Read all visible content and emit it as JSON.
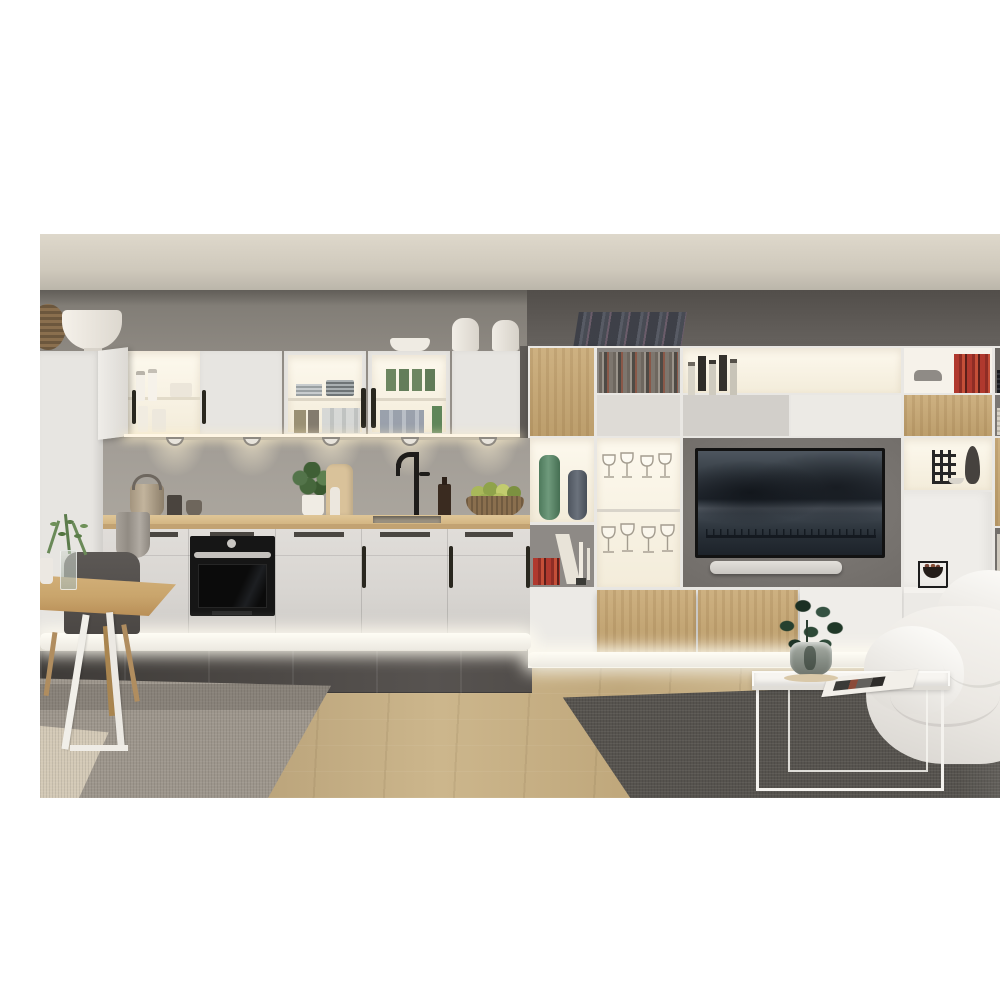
{
  "scene": {
    "type": "interior-photograph",
    "description": "Modern open-plan interior render: on the left a grey-white kitchen with illuminated glass wall cabinets, under-cabinet puck lights, wooden worktop, built-in black oven and glowing white plinth; on the right a floor-to-ceiling white and oak media wall unit with open shelves of books, bottles and vases around a wall-mounted TV showing a dusk seascape, with a soundbar below; foreground left has a light oak dining table with a dark grey chair on a mottled grey rug; foreground right has a white wire-frame tray coffee table with a green plant and magazine, a slouchy white bean-bag sofa and a dark grey rug, all on light oak plank flooring under a warm grey ceiling.",
    "regions": {
      "kitchen": {
        "wall_cabinets": [
          "open white cabinet with bottles",
          "closed white doors",
          "glass cabinet with grey plates and tumblers",
          "glass cabinet with green and blue glasses"
        ],
        "counter_items": [
          "teapot",
          "dark mug",
          "small bowl",
          "grey towel",
          "basil plant in white pot",
          "cutting board",
          "pepper mill",
          "black tap",
          "inset sink",
          "amber oil bottle",
          "woven bowl with green apples and pears"
        ],
        "base_units": [
          "drawer band with recessed handles",
          "black built-in oven with steel handle",
          "doors with black bar handles",
          "glowing white plinth"
        ],
        "top_decor": [
          "woven basket",
          "large white bowl",
          "small white bowl",
          "two white canisters"
        ],
        "lights": {
          "puck_lights": 5
        }
      },
      "media_wall": {
        "cells": [
          "oak door",
          "magazine cubby",
          "lit bar shelf with liquor bottles",
          "lit bar shelf with wine bottles",
          "white cubby with toy car and red books",
          "dark cubby with black book stack",
          "paper stack cubby",
          "lit cubby with green vase and blue-grey vase",
          "shelf with red books, leaning book and candles",
          "glass cabinet with two rows of wine glasses",
          "TV recess",
          "lit cubby with black wire candle holder, dark vase and glass bowl",
          "oak tall door",
          "light book cubby",
          "oak floating cabinets",
          "white floating cabinets",
          "black Kubus bowl on ledge",
          "leaning dark books on top",
          "LED glow under unit"
        ],
        "tv": {
          "screen": "dusk seascape with dark mountains and a pier of thin posts",
          "soundbar": "light grey"
        }
      },
      "dining": {
        "items": [
          "light oak table",
          "white A-frame table leg",
          "dark grey shell chair with wooden legs",
          "glass vase with green sprigs",
          "white cup"
        ]
      },
      "living": {
        "items": [
          "white wire-frame tray coffee table",
          "magazine",
          "green plant in grey glass vase",
          "white bean-bag sofa"
        ]
      },
      "surfaces": {
        "floor": "light oak planks",
        "kitchen_floor": "dark grey tiles",
        "rug_left": "mottled grey with cream corner",
        "rug_right": "dark heather grey"
      }
    },
    "palette": {
      "letterbox": "#ffffff",
      "ceiling": "#cfc9bc",
      "wall_left": "#928d86",
      "wall_right_dark": "#5e5a56",
      "cabinet_white": "#e7e5e1",
      "cabinet_glow": "#fbf5e8",
      "backsplash": "#a6a19a",
      "countertop": "#d9bd8e",
      "oven": "#141414",
      "plinth_glow": "#f8f6f1",
      "tile_dark": "#474340",
      "floor_oak": "#c7b086",
      "rug_left": "#9d968c",
      "rug_left_cream": "#d3c9b6",
      "rug_right": "#56534e",
      "unit_white": "#e9e7e3",
      "unit_oak": "#c8a873",
      "unit_back_grey": "#7b7773",
      "tv_bezel": "#141414",
      "soundbar": "#dad7d2",
      "sofa_white": "#f2f0ec",
      "table_wood": "#c9a873",
      "chair_grey": "#55514e",
      "plant_green": "#2f4a38",
      "vase_green": "#5f8a6b",
      "vase_blue": "#5c636e"
    }
  }
}
